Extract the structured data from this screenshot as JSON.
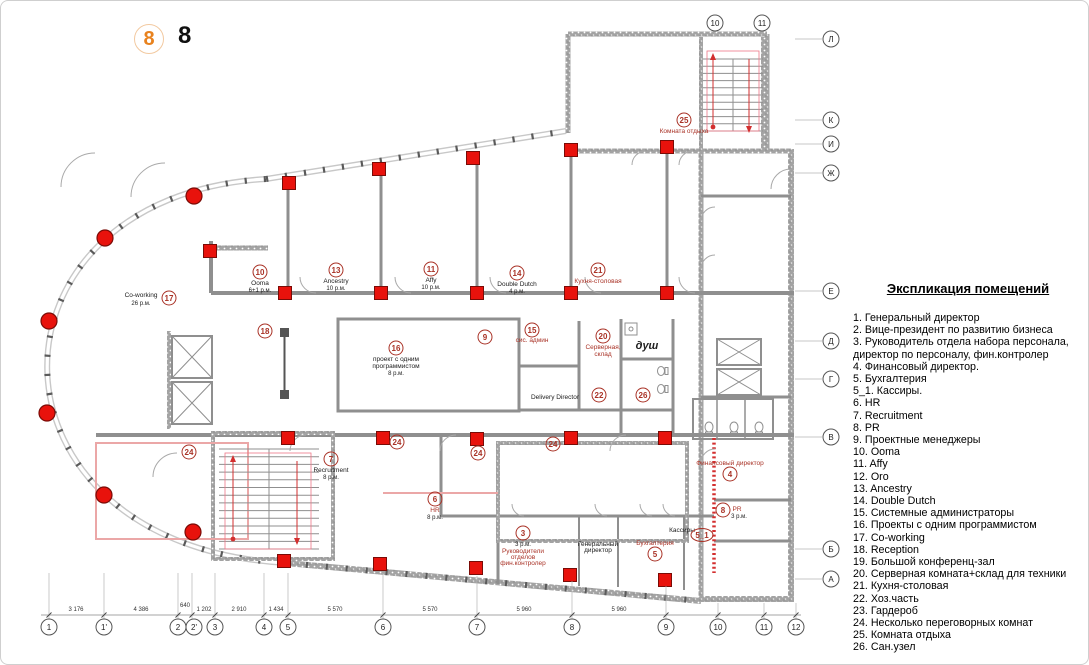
{
  "header": {
    "badge": "8",
    "number": "8"
  },
  "legend": {
    "title": "Экспликация помещений",
    "items": [
      "1. Генеральный директор",
      "2. Вице-президент по развитию бизнеса",
      "3. Руководитель отдела набора персонала, директор по персоналу, фин.контролер",
      "4. Финансовый директор.",
      "5. Бухгалтерия",
      "5_1. Кассиры.",
      "6. HR",
      "7. Recruitment",
      "8. PR",
      "9. Проектные менеджеры",
      "10. Ooma",
      "11. Affy",
      "12. Oro",
      "13. Ancestry",
      "14. Double Dutch",
      "15. Системные администраторы",
      "16. Проекты с одним программистом",
      "17. Co-working",
      "18. Reception",
      "19. Большой конференц-зал",
      "20. Серверная комната+склад для техники",
      "21. Кухня-столовая",
      "22. Хоз.часть",
      "23. Гардероб",
      "24. Несколько переговорных комнат",
      "25. Комната отдыха",
      "26. Сан.узел"
    ]
  },
  "plan": {
    "rooms": {
      "r17": {
        "num": "17",
        "name": "Co-working",
        "cap": "26 р.м."
      },
      "r10": {
        "num": "10",
        "name": "Ooma",
        "cap": "6+1 р.м."
      },
      "r13": {
        "num": "13",
        "name": "Ancestry",
        "cap": "10 р.м."
      },
      "r11": {
        "num": "11",
        "name": "Affy",
        "cap": "10 р.м."
      },
      "r14": {
        "num": "14",
        "name": "Double Dutch",
        "cap": "4 р.м."
      },
      "r21": {
        "num": "21",
        "name": "Кухня-столовая"
      },
      "r25": {
        "num": "25",
        "name": "Комната отдыха"
      },
      "r18": {
        "num": "18"
      },
      "r16": {
        "num": "16",
        "line1": "проект с одним",
        "line2": "программистом",
        "cap": "8 р.м."
      },
      "r9": {
        "num": "9"
      },
      "r15": {
        "num": "15",
        "name": "сис. админ"
      },
      "r20": {
        "num": "20",
        "line1": "Серверная,",
        "line2": "склад"
      },
      "shower": {
        "name": "душ"
      },
      "delivery": {
        "name": "Delivery Director"
      },
      "r22": {
        "num": "22"
      },
      "r26": {
        "num": "26"
      },
      "r7": {
        "num": "7",
        "name": "Recruitment",
        "cap": "8 р.м."
      },
      "r24": {
        "num": "24"
      },
      "r6": {
        "num": "6",
        "name": "HR",
        "cap": "8 р.м."
      },
      "r3": {
        "num": "3",
        "cap": "3 р.м.",
        "line1": "Руководители",
        "line2": "отделов",
        "line3": "фин.контролер"
      },
      "rgd": {
        "line1": "Генеральный",
        "line2": "директор"
      },
      "r5": {
        "num": "5",
        "name": "Бухгалтерия"
      },
      "r51": {
        "num": "5_1",
        "name": "Кассиры"
      },
      "r4": {
        "num": "4",
        "name": "Финансовый директор"
      },
      "r8": {
        "num": "8",
        "name": "PR",
        "cap": "3 р.м."
      }
    },
    "grid": {
      "top": [
        "10",
        "11"
      ],
      "bottom": [
        "1",
        "1'",
        "2",
        "2'",
        "3",
        "4",
        "5",
        "6",
        "7",
        "8",
        "9",
        "10",
        "11",
        "12"
      ],
      "right": [
        "Л",
        "К",
        "И",
        "Ж",
        "Е",
        "Д",
        "Г",
        "В",
        "Б",
        "А"
      ],
      "dims": [
        "3 176",
        "4 386",
        "640",
        "1 202",
        "2 910",
        "1 434",
        "5 570",
        "5 570",
        "5 960",
        "5 960"
      ]
    },
    "colors": {
      "column_red": "#e8120c",
      "label_red": "#a93226",
      "badge_orange": "#e8821e"
    }
  }
}
